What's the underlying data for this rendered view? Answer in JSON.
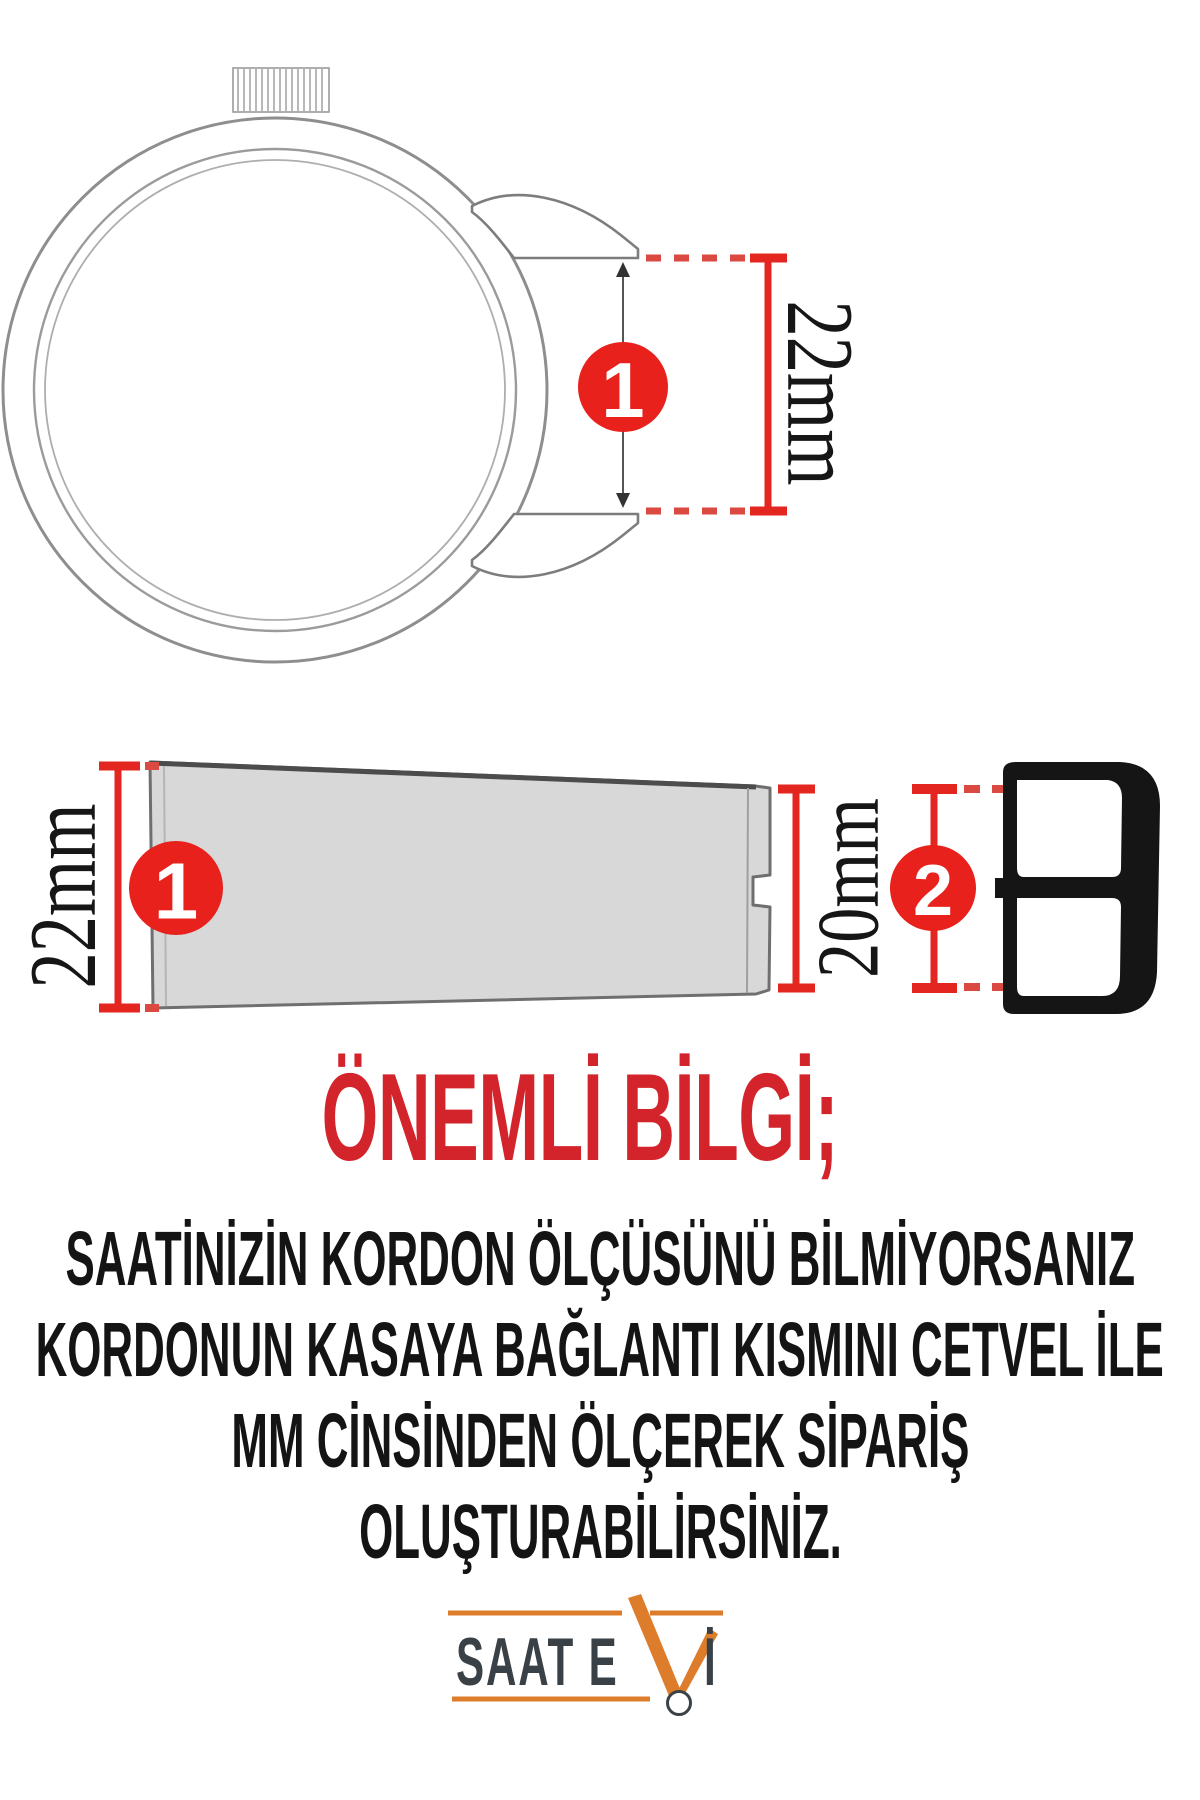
{
  "diagram": {
    "step1_badge": "1",
    "step2_badge": "2",
    "lug_width_label": "22mm",
    "strap_wide_end_label": "22mm",
    "strap_narrow_end_label": "20mm"
  },
  "heading": {
    "text": "ÖNEMLİ BİLGİ;"
  },
  "body": {
    "lines": [
      "SAATİNİZİN KORDON ÖLÇÜSÜNÜ BİLMİYORSANIZ",
      "KORDONUN KASAYA BAĞLANTI KISMINI CETVEL İLE",
      "MM CİNSİNDEN ÖLÇEREK SİPARİŞ",
      "OLUŞTURABİLİRSİNİZ."
    ]
  },
  "logo": {
    "text_main": "SAAT E",
    "text_i": "İ"
  },
  "colors": {
    "accent_red": "#e3261f",
    "dash_red": "#db4a40",
    "heading_red": "#d3242b",
    "text_black": "#141414",
    "strap_gray": "#d8d8d8",
    "outline_gray": "#8e8e8e",
    "logo_orange": "#dd7d2c",
    "logo_dark": "#394046",
    "buckle_black": "#151515"
  }
}
